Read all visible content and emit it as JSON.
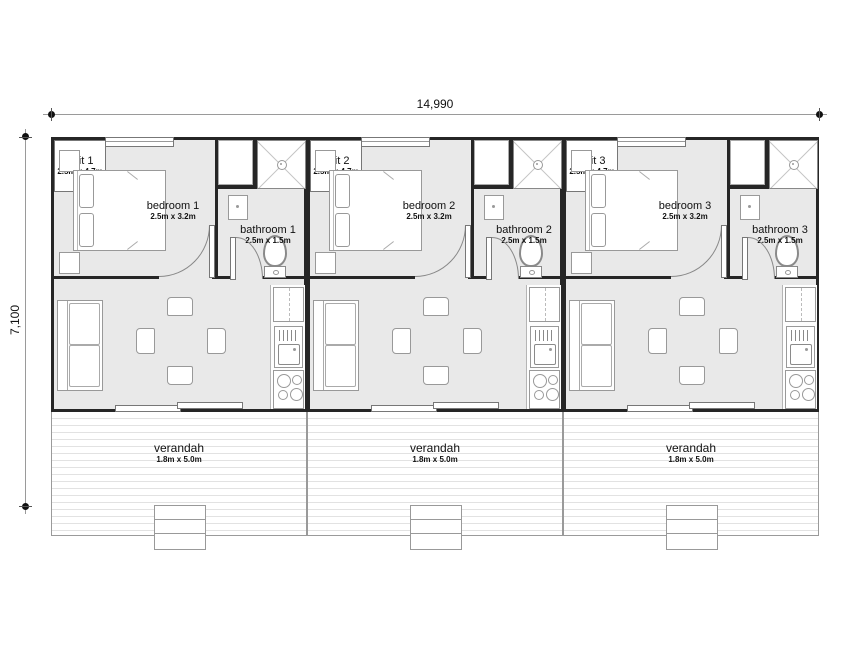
{
  "drawing": {
    "overall_width": "14,990",
    "overall_height": "7,100",
    "units": [
      {
        "bedroom": {
          "label": "bedroom 1",
          "size": "2.5m x 3.2m"
        },
        "bathroom": {
          "label": "bathroom 1",
          "size": "2.5m x 1.5m"
        },
        "living": {
          "label": "unit 1",
          "size": "2.5m x 4.7m"
        },
        "verandah": {
          "label": "verandah",
          "size": "1.8m x 5.0m"
        }
      },
      {
        "bedroom": {
          "label": "bedroom 2",
          "size": "2.5m x 3.2m"
        },
        "bathroom": {
          "label": "bathroom 2",
          "size": "2.5m x 1.5m"
        },
        "living": {
          "label": "unit 2",
          "size": "2.5m x 4.7m"
        },
        "verandah": {
          "label": "verandah",
          "size": "1.8m x 5.0m"
        }
      },
      {
        "bedroom": {
          "label": "bedroom 3",
          "size": "2.5m x 3.2m"
        },
        "bathroom": {
          "label": "bathroom 3",
          "size": "2.5m x 1.5m"
        },
        "living": {
          "label": "unit 3",
          "size": "2.5m x 4.7m"
        },
        "verandah": {
          "label": "verandah",
          "size": "1.8m x 5.0m"
        }
      }
    ],
    "colors": {
      "floor": "#e9e9e9",
      "wall": "#262626",
      "furniture_outline": "#999999",
      "deck_line": "#e2e2e2",
      "dimension": "#9a9a9a"
    }
  }
}
